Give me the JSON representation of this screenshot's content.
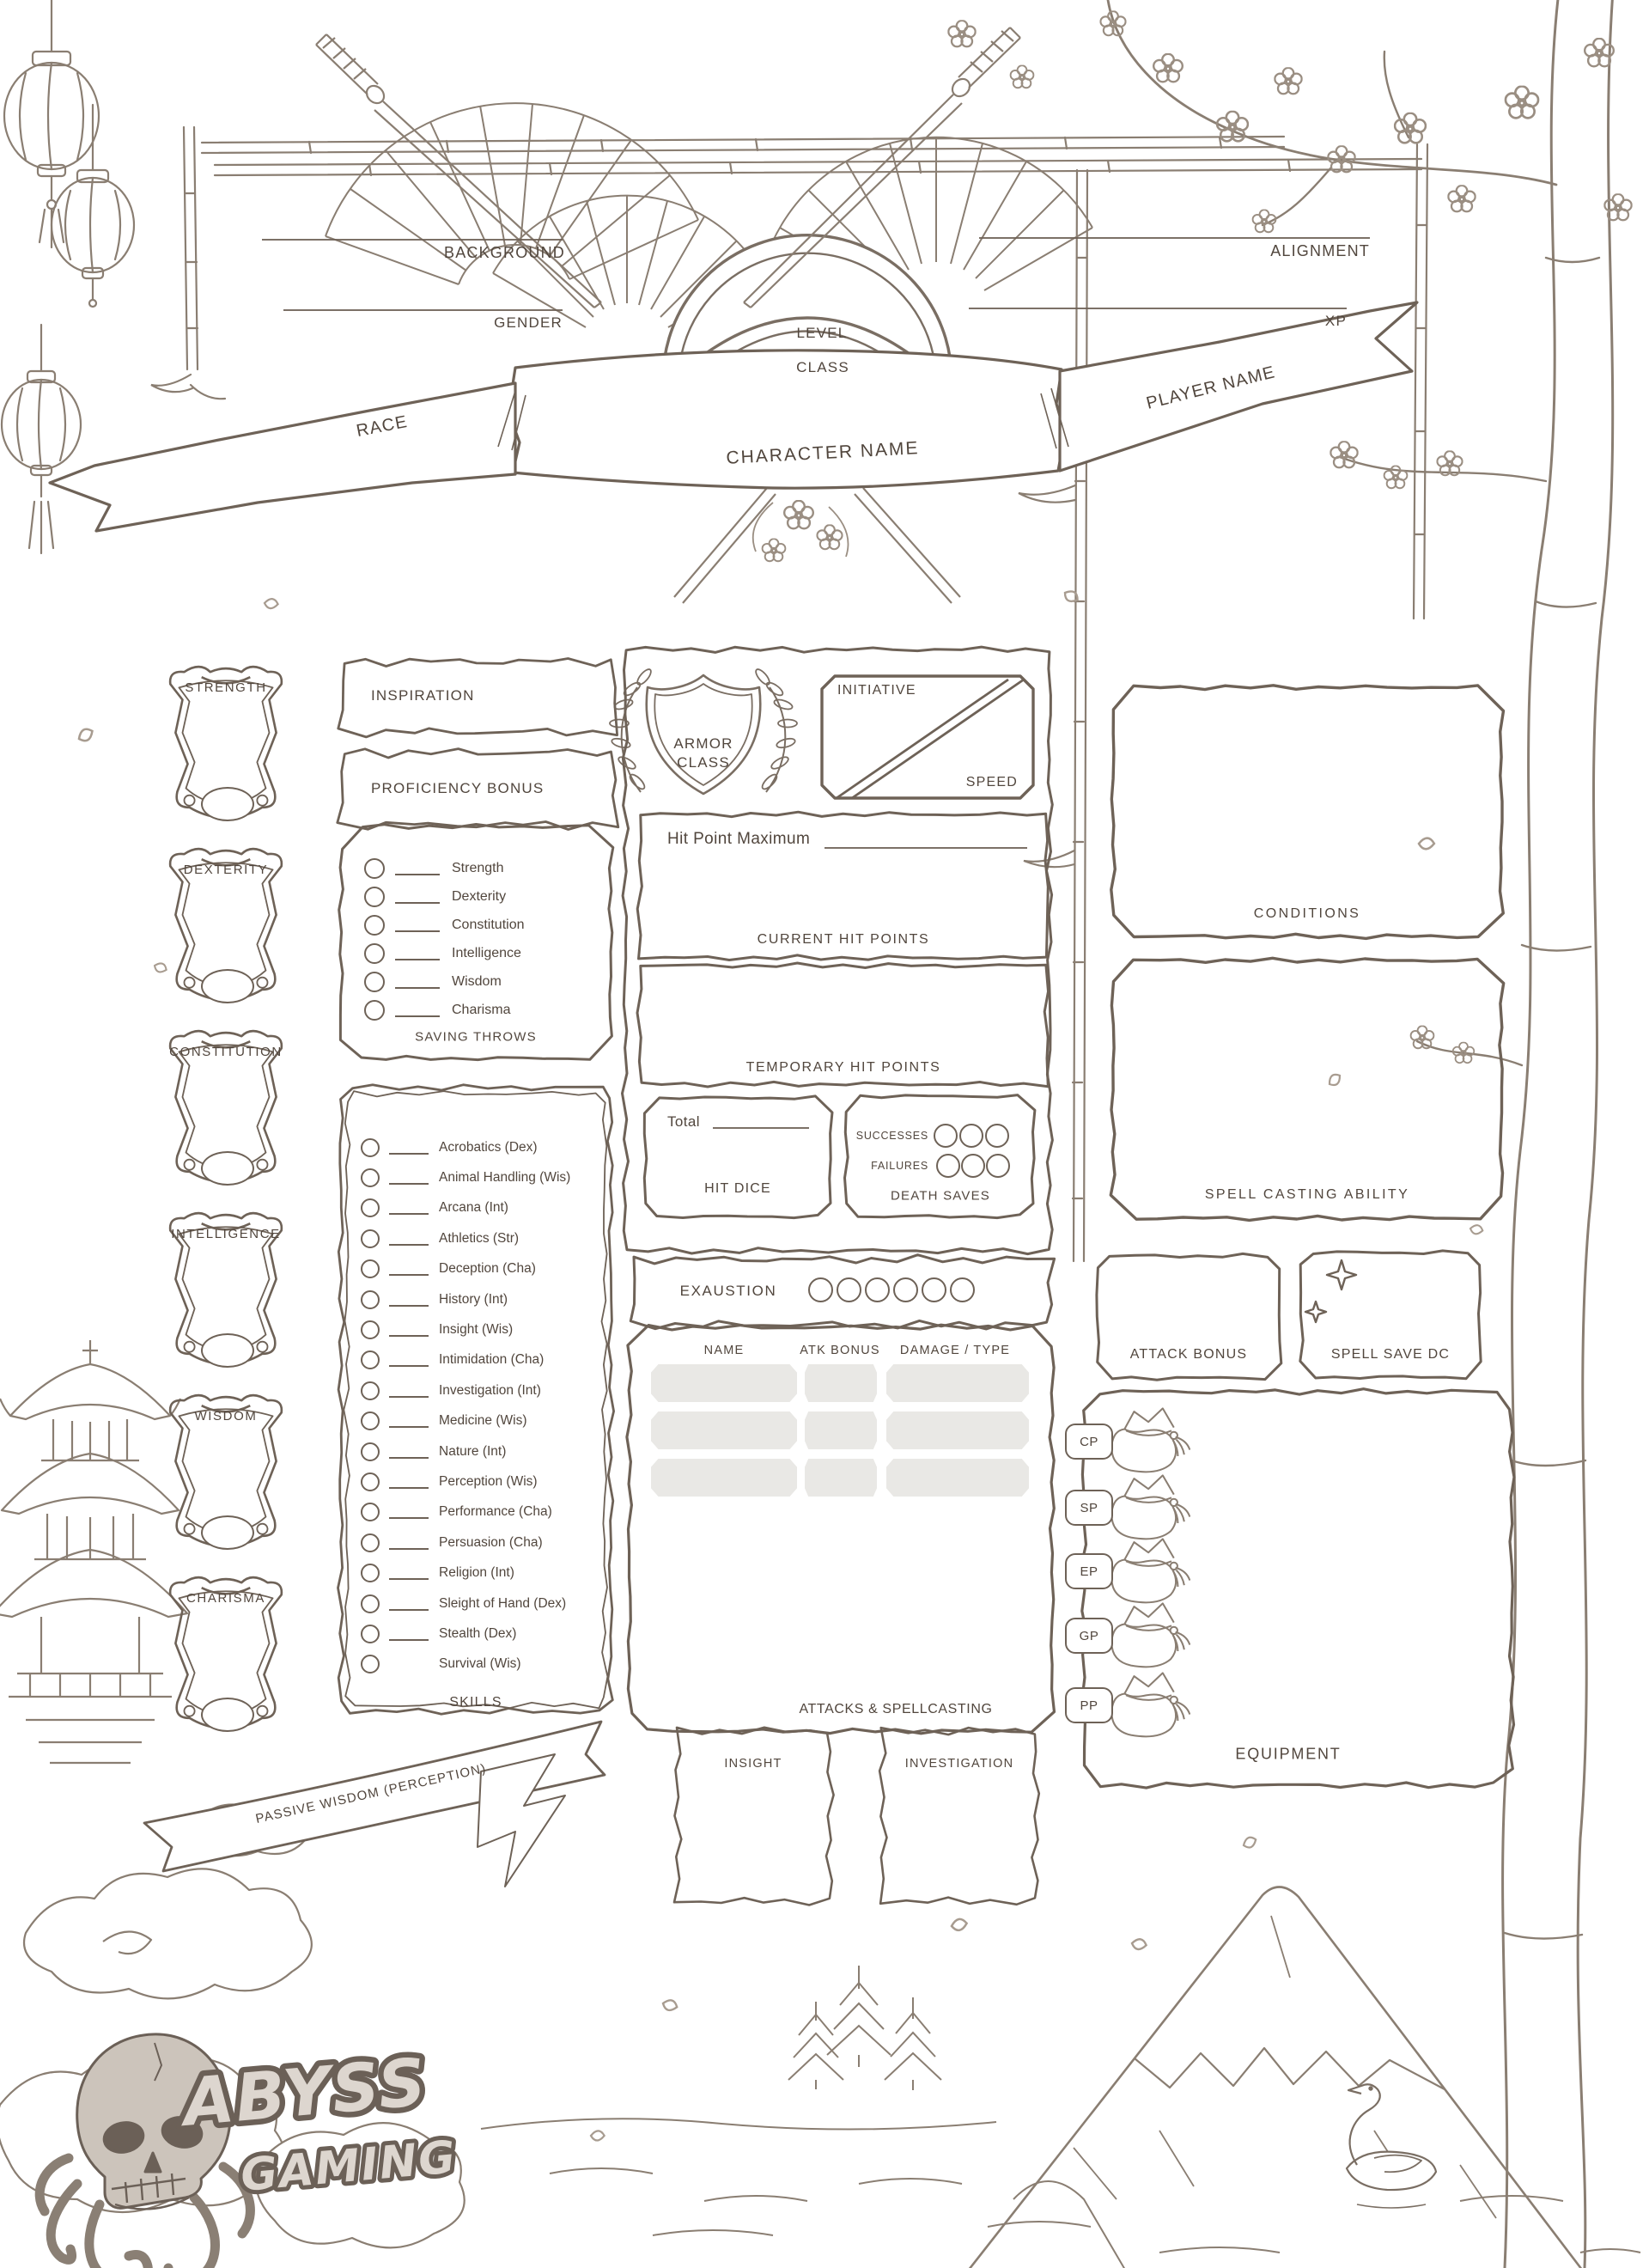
{
  "header": {
    "background_label": "BACKGROUND",
    "gender_label": "GENDER",
    "alignment_label": "ALIGNMENT",
    "xp_label": "XP",
    "level_label": "LEVEL",
    "class_label": "CLASS",
    "race_label": "RACE",
    "character_name_label": "CHARACTER NAME",
    "player_name_label": "PLAYER NAME"
  },
  "abilities": {
    "items": [
      "STRENGTH",
      "DEXTERITY",
      "CONSTITUTION",
      "INTELLIGENCE",
      "WISDOM",
      "CHARISMA"
    ]
  },
  "inspiration_label": "INSPIRATION",
  "proficiency_bonus_label": "PROFICIENCY BONUS",
  "saving_throws": {
    "title": "SAVING THROWS",
    "items": [
      "Strength",
      "Dexterity",
      "Constitution",
      "Intelligence",
      "Wisdom",
      "Charisma"
    ]
  },
  "skills": {
    "title": "SKILLS",
    "items": [
      "Acrobatics (Dex)",
      "Animal Handling (Wis)",
      "Arcana (Int)",
      "Athletics (Str)",
      "Deception (Cha)",
      "History (Int)",
      "Insight (Wis)",
      "Intimidation (Cha)",
      "Investigation (Int)",
      "Medicine (Wis)",
      "Nature (Int)",
      "Perception (Wis)",
      "Performance (Cha)",
      "Persuasion (Cha)",
      "Religion (Int)",
      "Sleight of Hand (Dex)",
      "Stealth (Dex)",
      "Survival (Wis)"
    ]
  },
  "combat": {
    "armor_class_line1": "ARMOR",
    "armor_class_line2": "CLASS",
    "initiative_label": "INITIATIVE",
    "speed_label": "SPEED",
    "hit_point_maximum_label": "Hit Point Maximum",
    "current_hit_points_label": "CURRENT HIT POINTS",
    "temporary_hit_points_label": "TEMPORARY HIT POINTS",
    "hit_dice_total_label": "Total",
    "hit_dice_title": "HIT DICE",
    "death_saves_title": "DEATH SAVES",
    "successes_label": "SUCCESSES",
    "failures_label": "FAILURES",
    "exhaustion_label": "EXAUSTION"
  },
  "attacks": {
    "title": "ATTACKS & SPELLCASTING",
    "columns": [
      "NAME",
      "ATK BONUS",
      "DAMAGE / TYPE"
    ]
  },
  "footer": {
    "passive_wisdom_label": "PASSIVE WISDOM (PERCEPTION)",
    "insight_label": "INSIGHT",
    "investigation_label": "INVESTIGATION"
  },
  "right_column": {
    "conditions_label": "CONDITIONS",
    "spell_casting_ability_label": "SPELL CASTING ABILITY",
    "attack_bonus_label": "ATTACK BONUS",
    "spell_save_dc_label": "SPELL SAVE DC",
    "equipment_label": "EQUIPMENT",
    "currencies": [
      "CP",
      "SP",
      "EP",
      "GP",
      "PP"
    ]
  },
  "branding": {
    "name_line1": "ABYSS",
    "name_line2": "GAMING"
  },
  "colors": {
    "ink": "#51463d",
    "frame": "#6e6257",
    "sketch": "#8a7e72",
    "cell_fill": "#e9e8e5",
    "logo_fill": "#ddd6cf",
    "logo_outline": "#6b6057"
  }
}
